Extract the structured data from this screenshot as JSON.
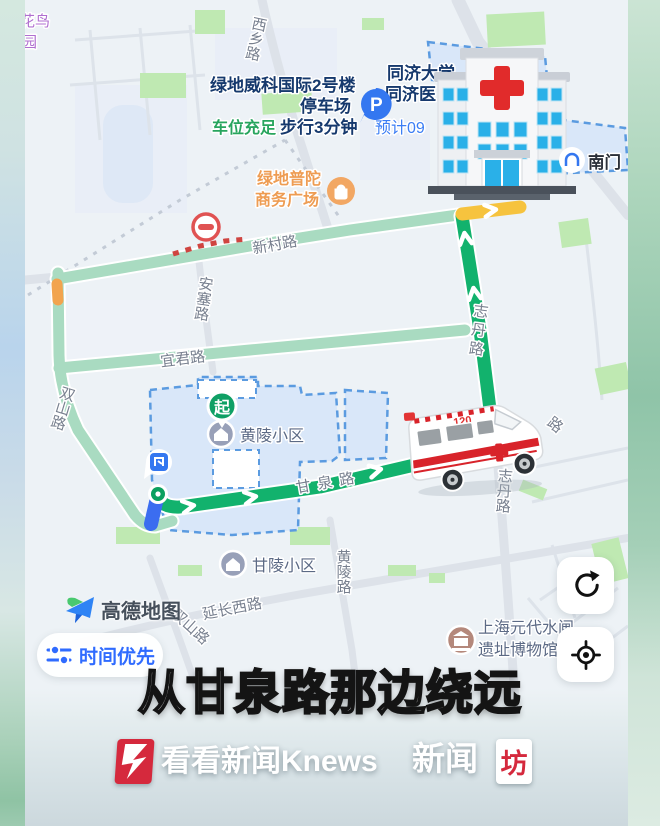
{
  "colors": {
    "route_active": "#12b26d",
    "route_alternate": "#a9dbc1",
    "congestion_yellow": "#f6c33e",
    "congestion_orange": "#f2a44e",
    "start_stub_blue": "#3b6df0",
    "accent_blue": "#2f6bff",
    "poi_navy": "#16396d",
    "brand_red": "#d5293d"
  },
  "map": {
    "labels": {
      "huaniao_1": "花鸟",
      "huaniao_2": "园",
      "xixiang_road": "西乡路",
      "parking_name_1": "绿地威科国际2号楼",
      "parking_name_2": "停车场",
      "parking_status": "车位充足",
      "walk_time": "步行3分钟",
      "parking_glyph": "P",
      "hospital_1": "同济大学",
      "hospital_2": "同济医",
      "eta": "预计09",
      "south_gate": "南门",
      "plaza_1": "绿地普陀",
      "plaza_2": "商务广场",
      "xincun_road": "新村路",
      "ansai_road": "安塞路",
      "yijun_road": "宜君路",
      "shuangshan_road_route": "双山路",
      "shuangshan_road_south": "双山路",
      "start_badge": "起",
      "huangling_estate": "黄陵小区",
      "ganquan_road": "甘泉路",
      "zhidan_road_route": "志丹路",
      "zhidan_road_south": "志丹路",
      "road_partial": "路",
      "ganling_estate": "甘陵小区",
      "huangling_road": "黄陵路",
      "yanchang_west_road": "延长西路",
      "museum_1": "上海元代水闸",
      "museum_2": "遗址博物馆",
      "ambulance_number": "120"
    }
  },
  "controls": {
    "amap_logo_text": "高德地图",
    "route_preference": "时间优先"
  },
  "icons": {
    "refresh": "circular-arrow",
    "locate": "crosshair-target",
    "route_pref": "sliders",
    "parking": "P-in-blue-circle",
    "no_entry": "red-circle-white-bar",
    "museum": "building-in-brown-circle",
    "estate": "house-in-gray-circle",
    "plaza": "bag-in-orange-circle",
    "gate": "arch-in-white-circle",
    "amap": "paper-plane"
  },
  "caption": "从甘泉路那边绕远",
  "footer": {
    "knews_text": "看看新闻Knews",
    "brand2_text": "新闻",
    "brand2_box": "坊"
  }
}
